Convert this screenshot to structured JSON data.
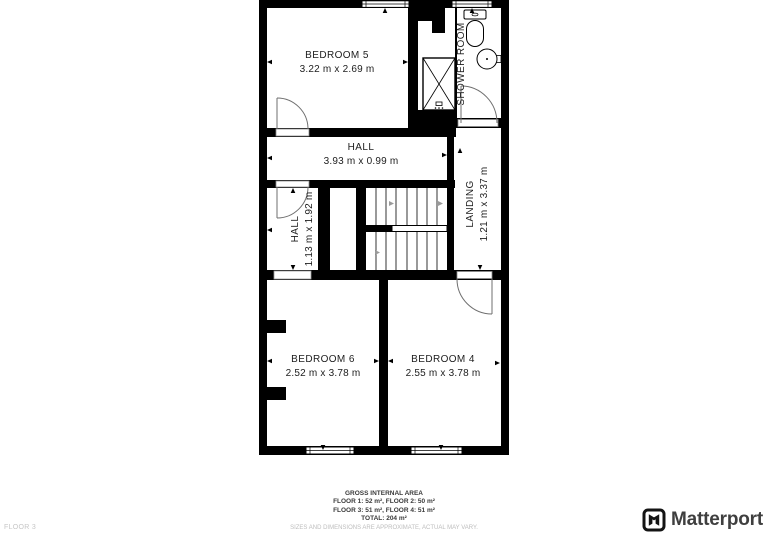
{
  "plan": {
    "rooms": [
      {
        "name": "BEDROOM 5",
        "dims": "3.22 m x 2.69 m"
      },
      {
        "name": "SHOWER ROOM",
        "dims": ""
      },
      {
        "name": "HALL",
        "dims": "3.93 m x 0.99 m"
      },
      {
        "name": "HALL",
        "dims": "1.13 m x 1.92 m"
      },
      {
        "name": "LANDING",
        "dims": "1.21 m x 3.37 m"
      },
      {
        "name": "BEDROOM 6",
        "dims": "2.52 m x 3.78 m"
      },
      {
        "name": "BEDROOM 4",
        "dims": "2.55 m x 3.78 m"
      }
    ]
  },
  "footer": {
    "floor_label": "FLOOR 3",
    "gross_title": "GROSS INTERNAL AREA",
    "line1": "FLOOR 1: 52 m², FLOOR 2: 50 m²",
    "line2": "FLOOR 3: 51 m², FLOOR 4: 51 m²",
    "total": "TOTAL: 204 m²",
    "disclaimer": "SIZES AND DIMENSIONS ARE APPROXIMATE, ACTUAL MAY VARY.",
    "brand": "Matterport"
  },
  "colors": {
    "wall": "#000000",
    "label_text": "#1d1d1d",
    "muted_text": "#c0c0c0",
    "brand_text": "#3f3f3f"
  }
}
